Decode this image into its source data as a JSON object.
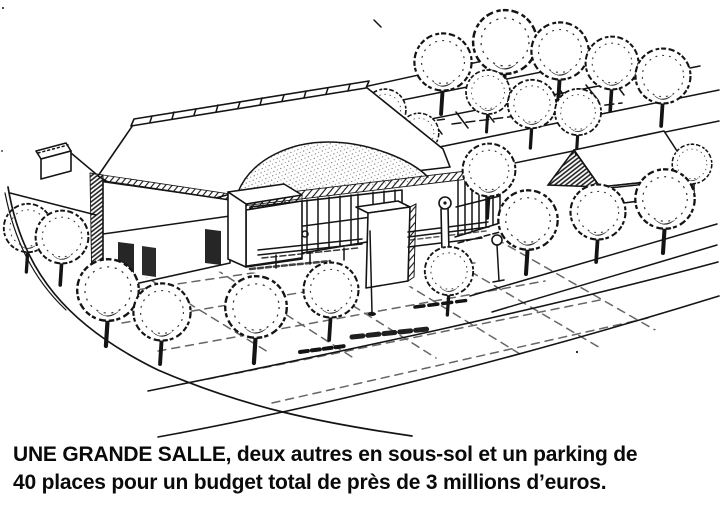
{
  "colors": {
    "ink": "#141414",
    "paper": "#ffffff"
  },
  "figure": {
    "subject": "black-and-white architectural perspective sketch of a large hall with a domed roof, entrance tower, surrounding trees, paved plaza, parking rows and a neighbouring pitched-roof house"
  },
  "caption": {
    "line1": "UNE GRANDE SALLE, deux autres en sous-sol et un parking de",
    "line2": "40 places pour un budget total de près de 3 millions d’euros."
  }
}
